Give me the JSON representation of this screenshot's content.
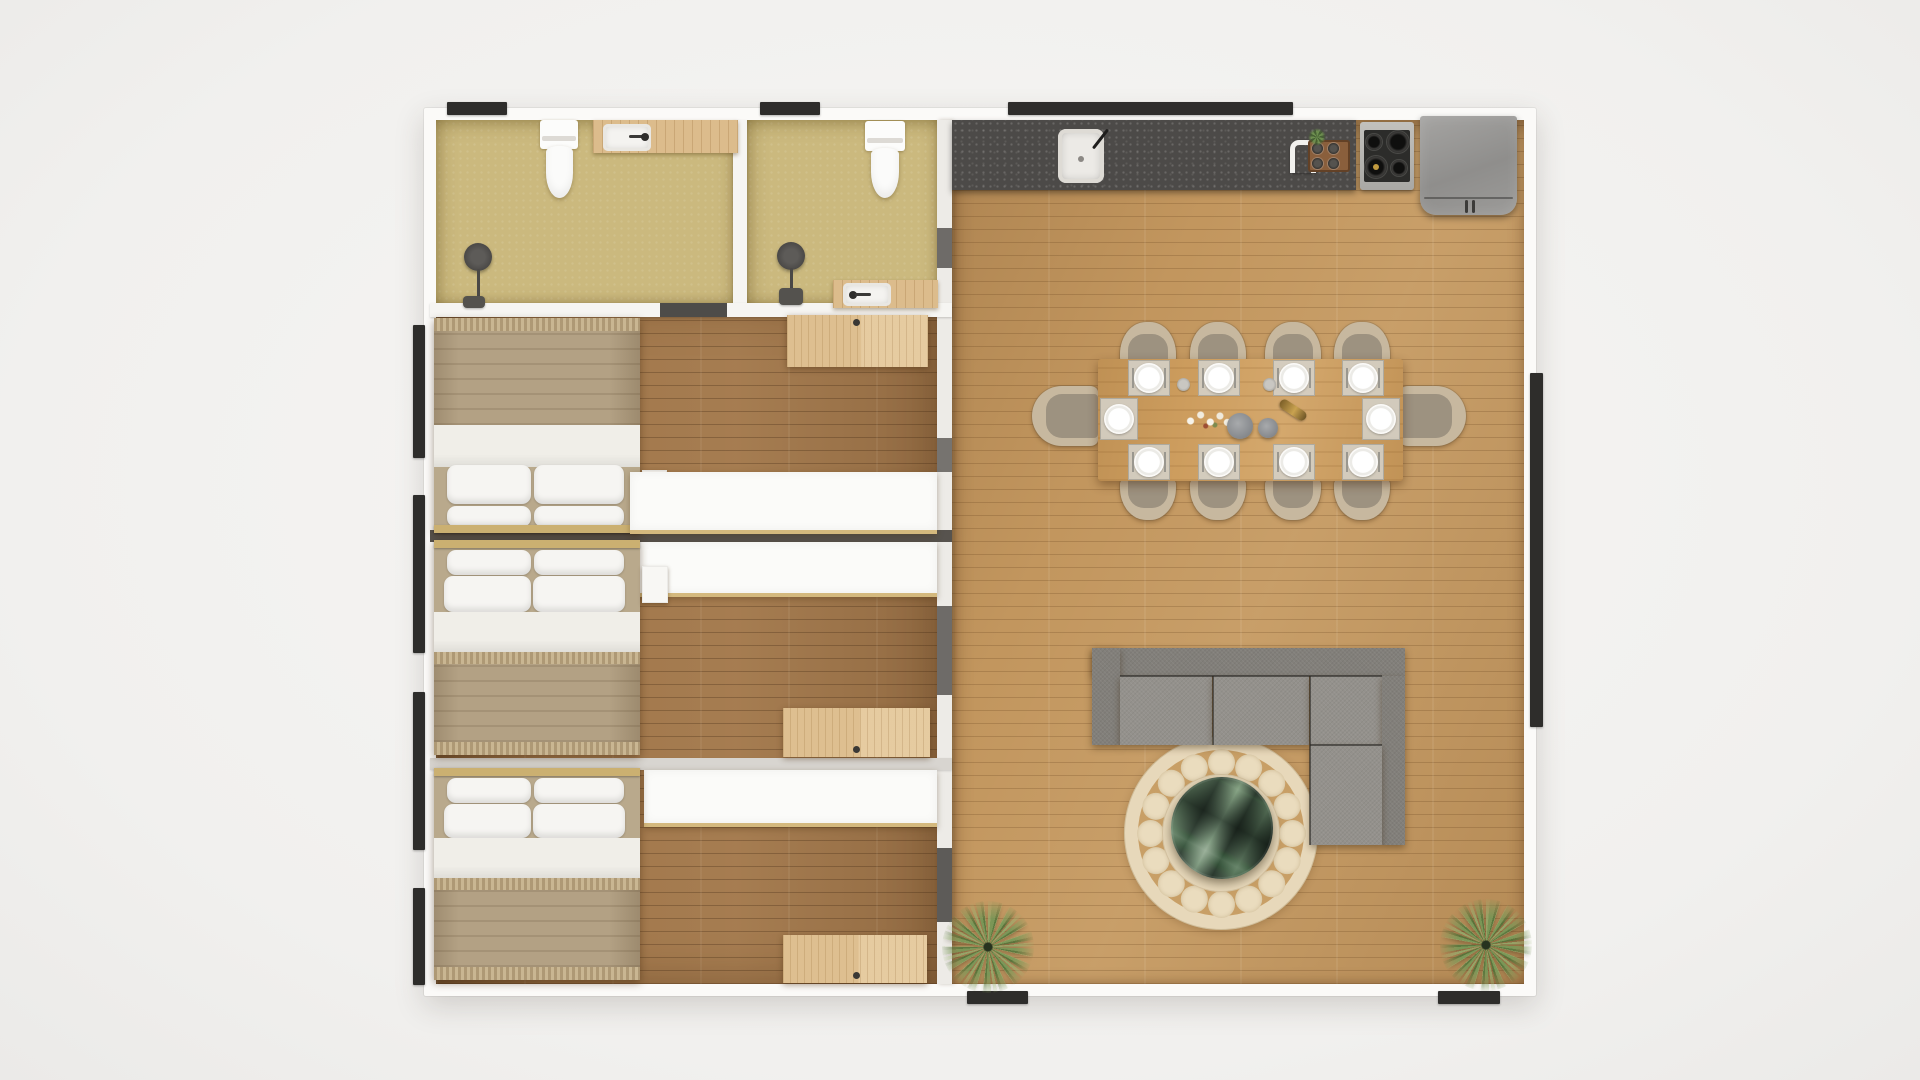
{
  "document": {
    "title": "Apartment floor plan — top-down 3D render",
    "type": "3d-rendered-floor-plan"
  },
  "palette": {
    "background": "#f1f0ee",
    "outer_wall": "#fbfaf8",
    "bathroom_floor": "#cbb97e",
    "bedroom_floor": "#a1774b",
    "living_floor": "#c2965e",
    "counter": "#4c4a48",
    "sofa": "#94918c",
    "rug_cream": "#e7d8ba",
    "table_wood": "#cd9d5e",
    "blanket": "#b3a184",
    "opening_dark": "#2e2d2b",
    "closet_white": "#fbfbf9",
    "gold_trim": "#cbb071"
  },
  "rooms": [
    {
      "id": "bathroom-1",
      "label": "Bathroom 1 (en-suite, top left)",
      "fixtures": [
        "toilet",
        "wood vanity with sink",
        "floor shower"
      ]
    },
    {
      "id": "bathroom-2",
      "label": "Bathroom 2 (top middle)",
      "fixtures": [
        "toilet",
        "wood vanity with sink",
        "floor shower"
      ]
    },
    {
      "id": "bedroom-1",
      "label": "Bedroom 1",
      "furniture": [
        "double bed (4 pillows)",
        "white nightstand",
        "wood dresser",
        "white wardrobe"
      ]
    },
    {
      "id": "bedroom-2",
      "label": "Bedroom 2",
      "furniture": [
        "double bed (4 pillows)",
        "white nightstand",
        "wood dresser",
        "white wardrobe"
      ]
    },
    {
      "id": "bedroom-3",
      "label": "Bedroom 3",
      "furniture": [
        "double bed (4 pillows)",
        "wood dresser",
        "white wardrobe"
      ]
    },
    {
      "id": "living-area",
      "label": "Open-plan kitchen, dining and living room",
      "furniture": [
        "kitchen counter",
        "dining table for 10",
        "L-shaped gray sectional sofa",
        "round patterned rug",
        "round green-marble coffee table",
        "2 potted plants"
      ]
    }
  ],
  "kitchen": {
    "appliances": [
      "inset sink with faucet",
      "4-burner cooktop",
      "gray refrigerator"
    ],
    "counter_items": [
      "paper-towel holder",
      "wooden spice tray with 4 jars",
      "small plant"
    ]
  },
  "dining": {
    "seats": 10,
    "place_settings": 10,
    "table_decor": [
      "white flower sprigs",
      "2 gray candles",
      "brass grinder",
      "2 small cups"
    ]
  },
  "living": {
    "sofa": "L-shaped gray sectional",
    "rug": {
      "shape": "round",
      "dot_count": 16
    },
    "coffee_table": "round green marble",
    "floor_plants": 2
  },
  "openings": {
    "top_wall": 3,
    "left_wall": 4,
    "right_wall": 1,
    "bottom_wall": 2
  }
}
